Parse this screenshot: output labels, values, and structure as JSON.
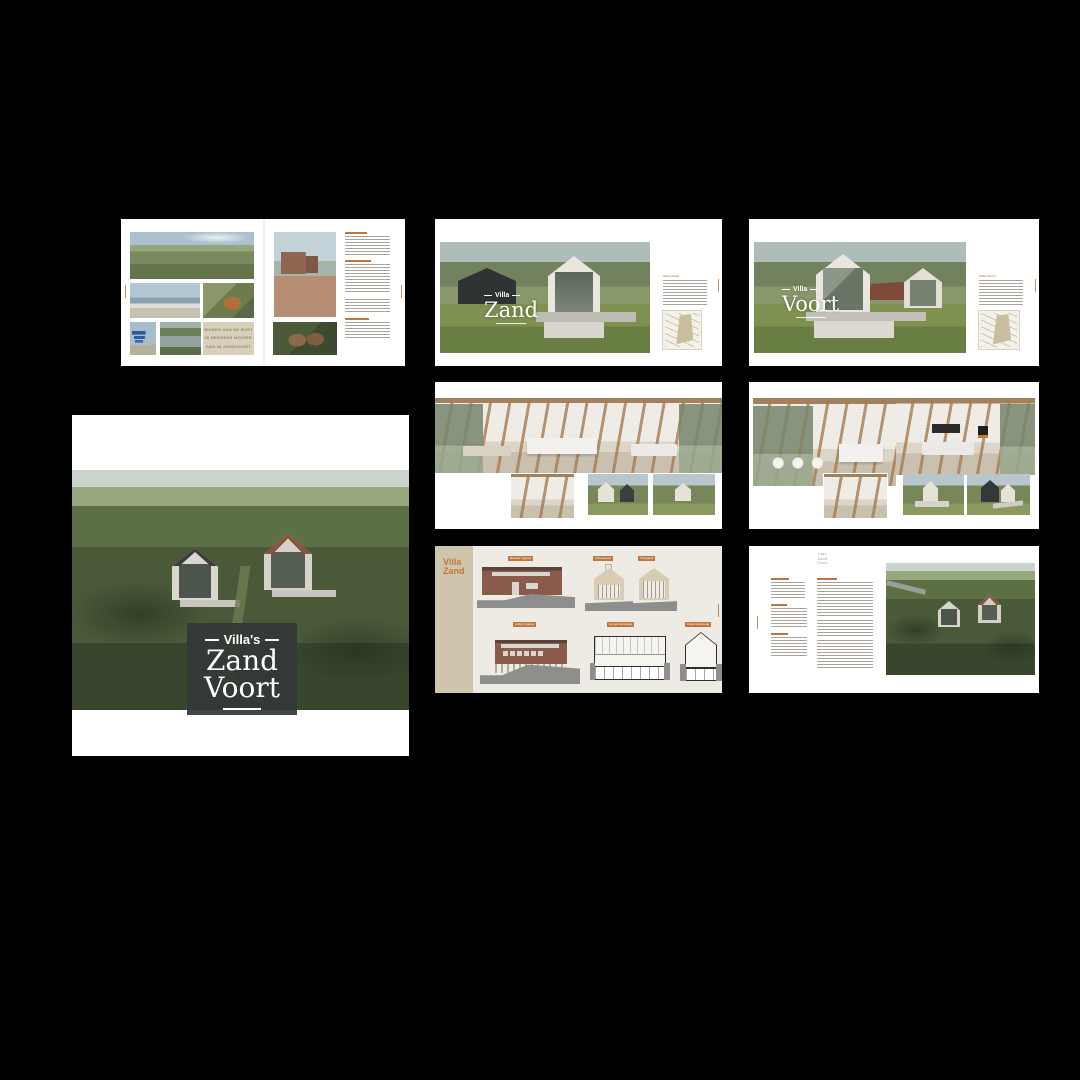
{
  "view": {
    "canvas_bg": "#000000",
    "page_bg": "#ffffff",
    "accent": "#c0763c",
    "sidebar_beige": "#cfc5ad",
    "quote_bg": "#d9d0bb",
    "badge_bg": "#343836"
  },
  "cover": {
    "prefix": "Villa's",
    "word1": "Zand",
    "word2": "Voort"
  },
  "intro": {
    "quote_line1": "WONEN AAN DE RUST",
    "quote_line2": "IS NERGENS MOOIER",
    "quote_line3": "DAN IN ZANDVOORT"
  },
  "villa_zand": {
    "overlay_label": "Villa",
    "overlay_name": "Zand",
    "aside_heading": "Villa Zand"
  },
  "villa_voort": {
    "overlay_label": "Villa",
    "overlay_name": "Voort",
    "aside_heading": "Villa Voort"
  },
  "drawings": {
    "sidebar_title_line1": "Villa",
    "sidebar_title_line2": "Zand",
    "labels": [
      "Rechter zijgevel",
      "Achtergevel",
      "Voorgevel",
      "Linker zijgevel",
      "Lange doorsnede",
      "Korte doorsnede"
    ]
  },
  "contact": {
    "logo_prefix": "Villa's",
    "logo_word1": "Zand",
    "logo_word2": "Voort"
  }
}
